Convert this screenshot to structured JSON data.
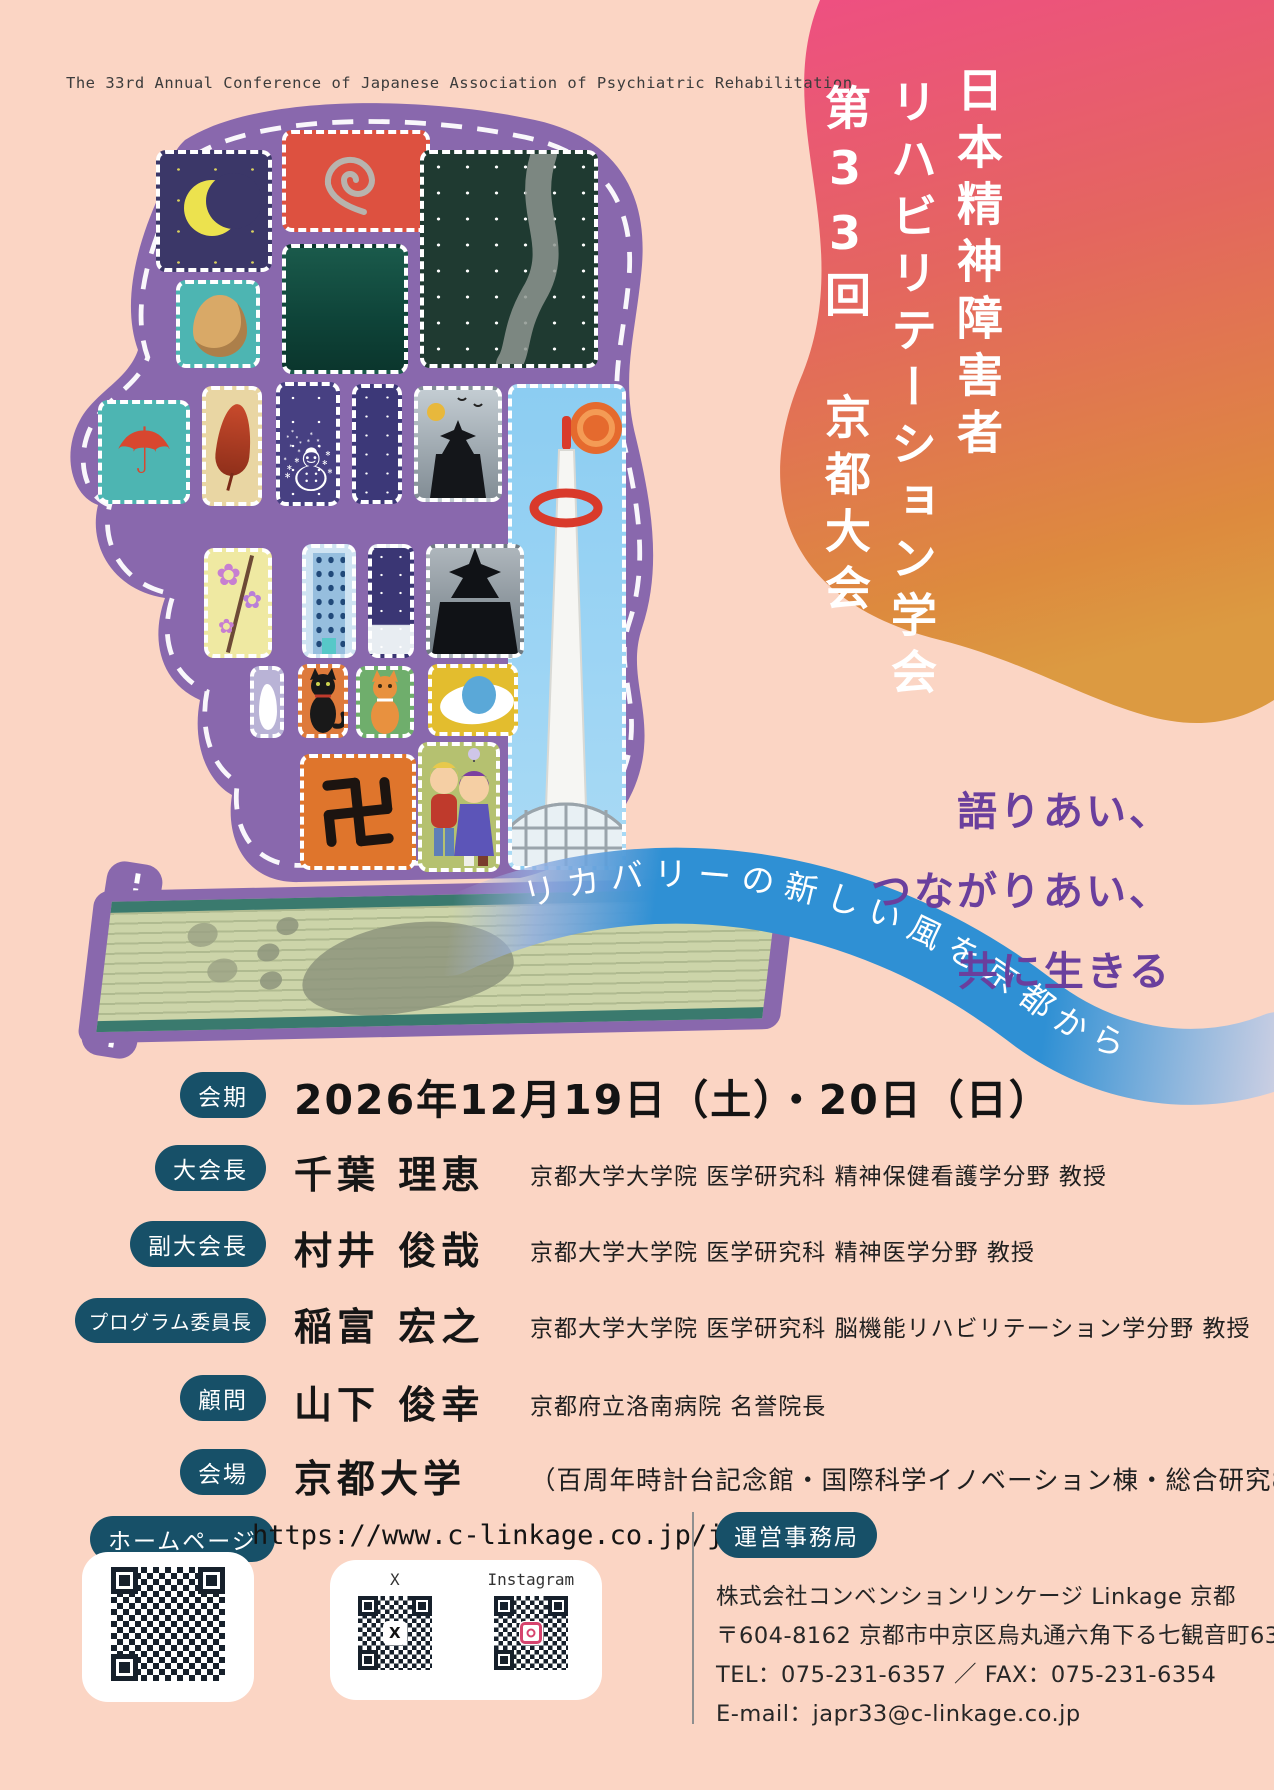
{
  "page": {
    "background": "#fbd5c4"
  },
  "header": {
    "english_title": "The 33rd Annual Conference of Japanese Association of Psychiatric Rehabilitation"
  },
  "title_block": {
    "line1": "日本精神障害者",
    "line2": "リハビリテーション学会",
    "line3": "第33回 京都大会",
    "gradient_top": "#ee4f82",
    "gradient_bottom": "#dd8a3e"
  },
  "catchphrase": {
    "line1": "語りあい、",
    "line2": "つながりあい、",
    "line3": "共に生きる",
    "color": "#6a3f9d"
  },
  "ribbon": {
    "text": "リカバリーの新しい風を京都から",
    "color": "#2f90d4"
  },
  "schedule": {
    "badge": "会期",
    "value": "2026年12月19日（土）・20日（日）"
  },
  "officers": [
    {
      "badge": "大会長",
      "name": "千葉 理恵",
      "affiliation": "京都大学大学院 医学研究科 精神保健看護学分野 教授"
    },
    {
      "badge": "副大会長",
      "name": "村井 俊哉",
      "affiliation": "京都大学大学院 医学研究科 精神医学分野 教授"
    },
    {
      "badge": "プログラム委員長",
      "name": "稲富 宏之",
      "affiliation": "京都大学大学院 医学研究科 脳機能リハビリテーション学分野 教授"
    },
    {
      "badge": "顧問",
      "name": "山下 俊幸",
      "affiliation": "京都府立洛南病院 名誉院長"
    },
    {
      "badge": "会場",
      "name": "京都大学",
      "affiliation": "（百周年時計台記念館・国際科学イノベーション棟・総合研究8号館）"
    }
  ],
  "website": {
    "badge": "ホームページ",
    "url": "https://www.c-linkage.co.jp/japr33/",
    "x_label": "X",
    "instagram_label": "Instagram",
    "x_logo": "X"
  },
  "secretariat": {
    "badge": "運営事務局",
    "line1": "株式会社コンベンションリンケージ Linkage 京都",
    "line2": "〒604-8162 京都市中京区烏丸通六角下る七観音町634",
    "line3": "TEL：075-231-6357 ／ FAX：075-231-6354",
    "line4": "E-mail：japr33@c-linkage.co.jp"
  },
  "artwork": {
    "description": "patchwork head-profile collage of purple roads with dashed lanes",
    "head_color": "#8968ad",
    "tatami_color": "#ccd4a9",
    "tiles": [
      "crescent-moon",
      "spiral",
      "mountain",
      "snowy-river-night",
      "egg",
      "paper-umbrella",
      "autumn-leaf",
      "snowman",
      "starry-night",
      "pagoda-in-clouds",
      "kyoto-tower",
      "cherry-blossom",
      "office-building",
      "night-snow",
      "pagoda-silhouette",
      "rabbit",
      "black-cat",
      "orange-cat",
      "balloon-eye",
      "two-friends",
      "manji-symbol",
      "tatami-footprint"
    ]
  }
}
